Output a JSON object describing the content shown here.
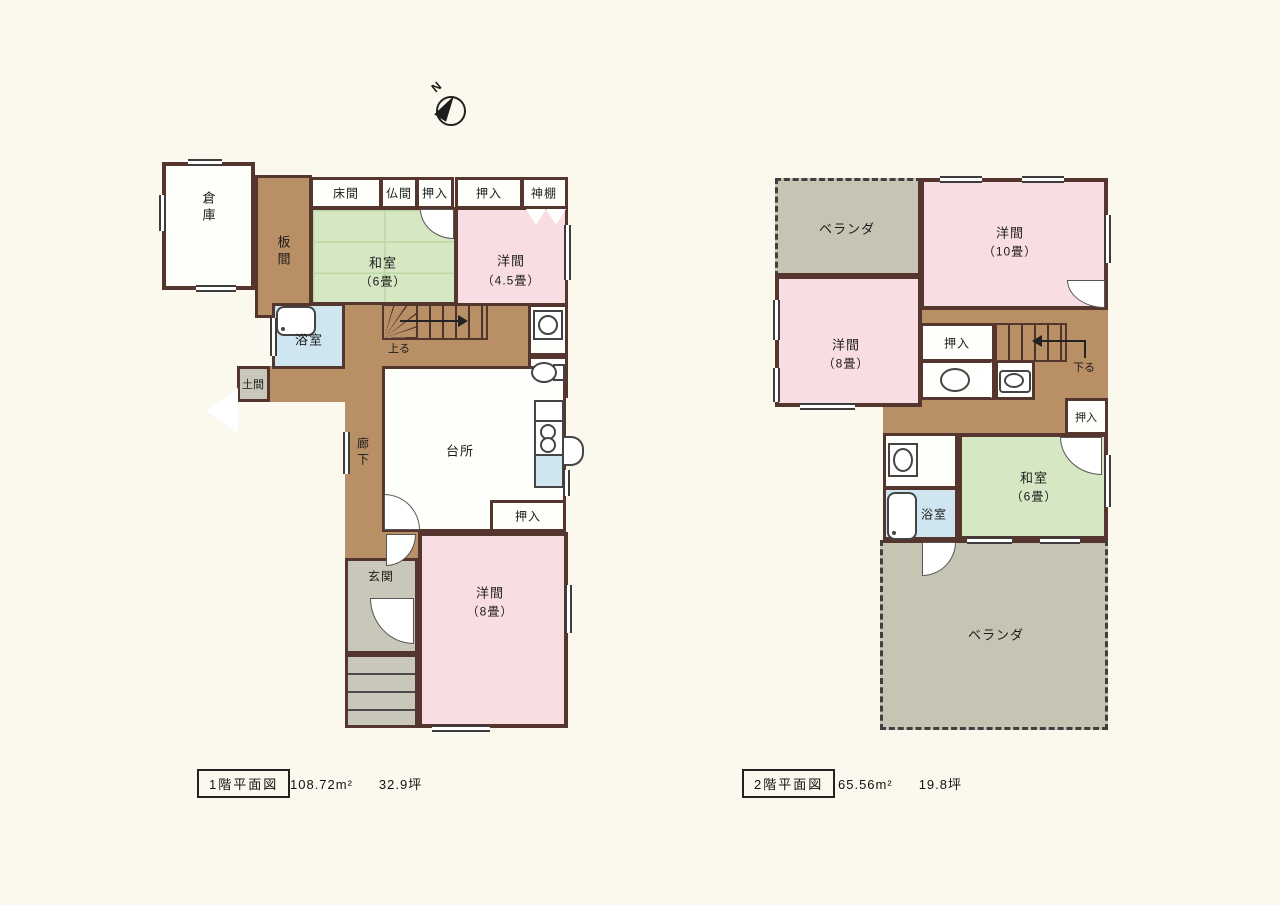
{
  "compass": {
    "north": "N"
  },
  "colors": {
    "background": "#fbf9ee",
    "wall": "#54362e",
    "wood_floor": "#b98f66",
    "tatami": "#d6e8c3",
    "western_room": "#f8dde3",
    "bath": "#cfe5ef",
    "entry_gray": "#c9c7b9",
    "veranda": "#c6c4b2",
    "white_room": "#fefefb"
  },
  "icons": {
    "north_arrow": "compass-needle-in-circle",
    "bathtub": "rounded-rect-with-drain-dot",
    "toilet": "oval-bowl-with-tank",
    "washbasin": "oval-in-rect",
    "corner_basin": "corner-triangle",
    "washing_machine": "square-with-circle",
    "stove": "two-burner-circles",
    "sink": "blue-rect",
    "door_swing": "quarter-arc"
  },
  "floor1": {
    "caption_title": "1階平面図",
    "caption_area": "108.72m²",
    "caption_tsubo": "32.9坪",
    "rooms": {
      "souko": "倉庫",
      "itanoma": "板間",
      "tokonoma": "床間",
      "butsuma": "仏間",
      "oshiire_top1": "押入",
      "oshiire_top2": "押入",
      "kamidana": "神棚",
      "washitsu_name": "和室",
      "washitsu_size": "（6畳）",
      "youma45_name": "洋間",
      "youma45_size": "（4.5畳）",
      "yokushitsu": "浴室",
      "doma": "土間",
      "stairs_up": "上る",
      "rouka": "廊下",
      "daidokoro": "台所",
      "oshiire_kitchen": "押入",
      "genkan": "玄関",
      "youma8_name": "洋間",
      "youma8_size": "（8畳）"
    }
  },
  "floor2": {
    "caption_title": "2階平面図",
    "caption_area": "65.56m²",
    "caption_tsubo": "19.8坪",
    "rooms": {
      "veranda_top": "ベランダ",
      "youma10_name": "洋間",
      "youma10_size": "（10畳）",
      "youma8_name": "洋間",
      "youma8_size": "（8畳）",
      "oshiire_center": "押入",
      "stairs_down": "下る",
      "oshiire_right": "押入",
      "washitsu_name": "和室",
      "washitsu_size": "（6畳）",
      "yokushitsu": "浴室",
      "veranda_bottom": "ベランダ"
    }
  }
}
